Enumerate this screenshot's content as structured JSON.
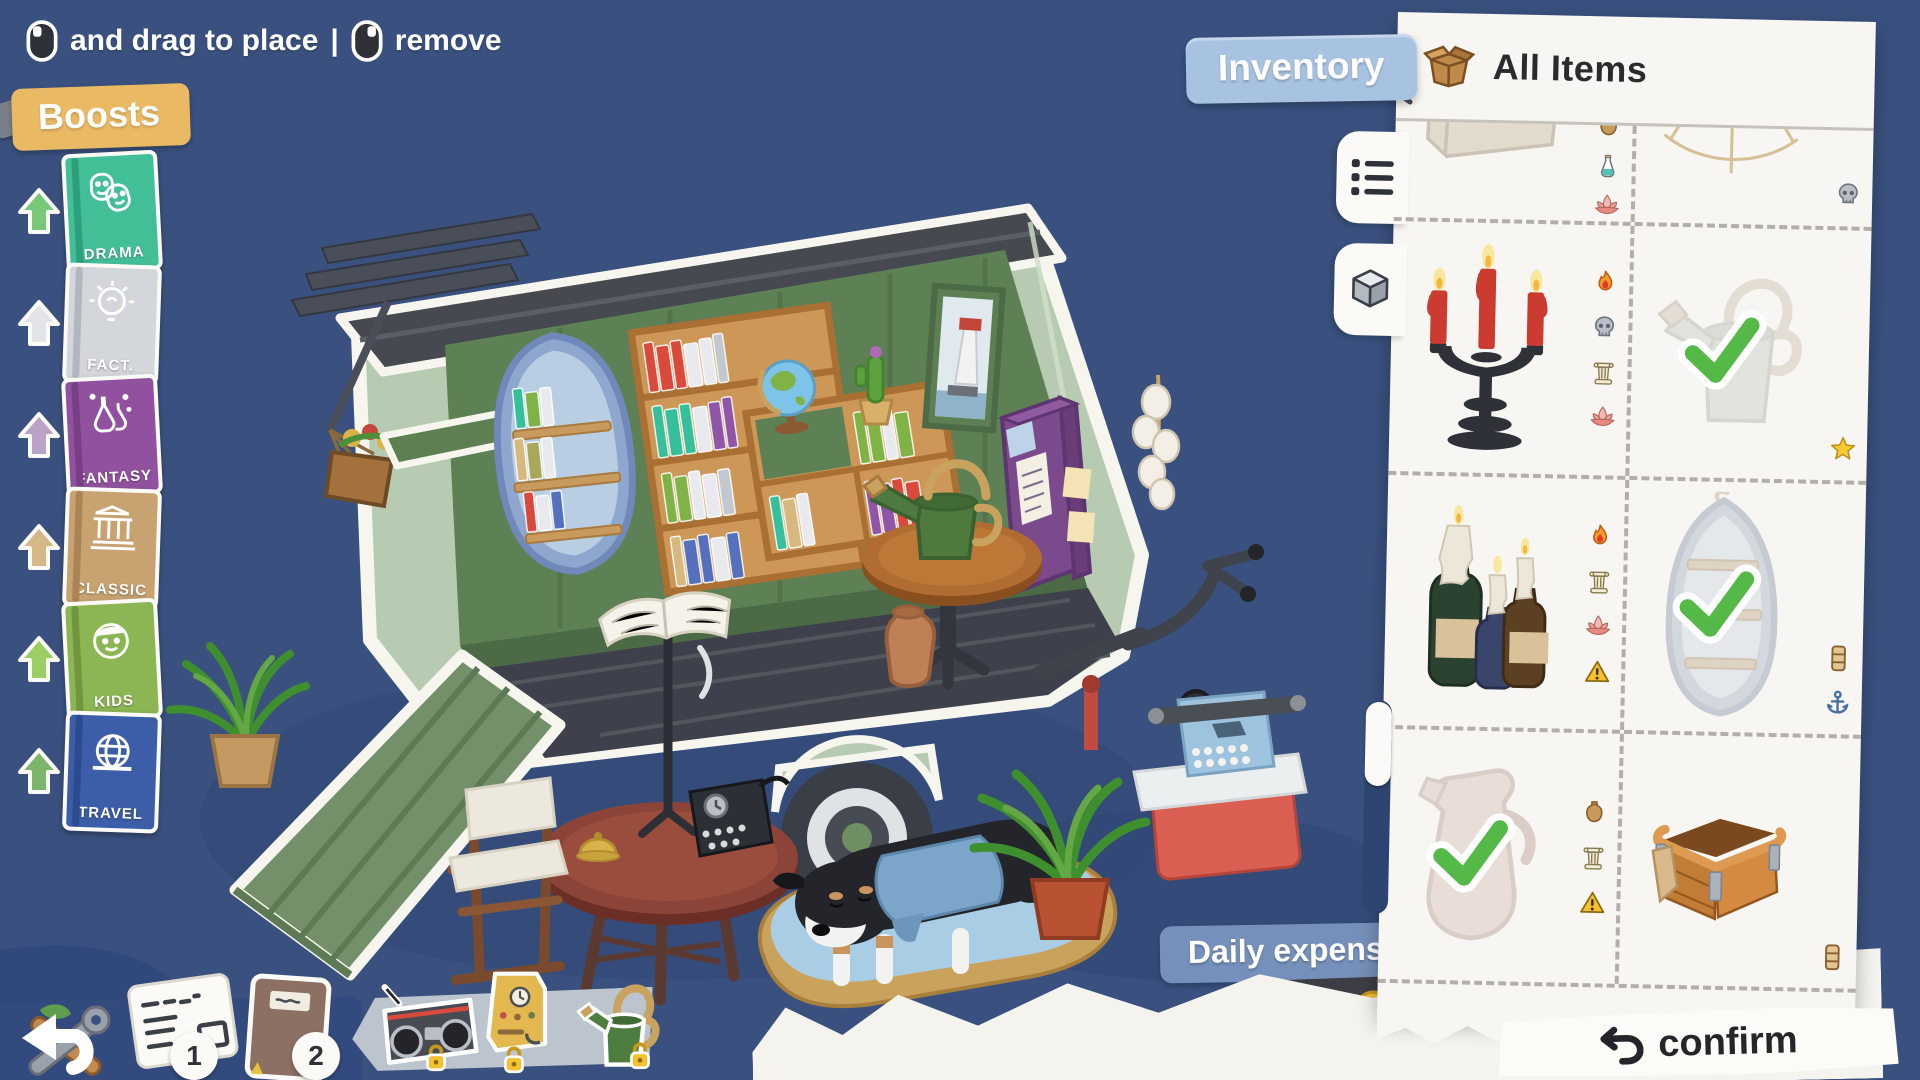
{
  "colors": {
    "background": "#3a517f",
    "panel": "#f8f6f2",
    "boosts_tag": "#e9b963",
    "inventory_button": "#a8c2e2",
    "expenses_label": "#7590ba",
    "expenses_chip": "#3d3d45",
    "check_green": "#55b948",
    "coin_gold": "#f2c230",
    "dashed_divider": "#b3afa8"
  },
  "hints": {
    "drag_label": "and drag to place",
    "divider": "|",
    "remove_label": "remove"
  },
  "boosts": {
    "label": "Boosts",
    "books": [
      {
        "label": "DRAMA",
        "icon": "theater-masks-icon",
        "cover": "#43bf97",
        "spine": "#2d9f7c",
        "arrow": "#79c878"
      },
      {
        "label": "FACT.",
        "icon": "lightbulb-icon",
        "cover": "#d3d6da",
        "spine": "#b2b6be",
        "arrow": "#e2e5e8"
      },
      {
        "label": "FANTASY",
        "icon": "potion-flasks-icon",
        "cover": "#91519f",
        "spine": "#773f85",
        "arrow": "#b9a3c6"
      },
      {
        "label": "CLASSIC",
        "icon": "greek-temple-icon",
        "cover": "#c8a271",
        "spine": "#aa8455",
        "arrow": "#d6b887"
      },
      {
        "label": "KIDS",
        "icon": "child-face-icon",
        "cover": "#8cb553",
        "spine": "#71963e",
        "arrow": "#9ccf63"
      },
      {
        "label": "TRAVEL",
        "icon": "globe-icon",
        "cover": "#3c5da8",
        "spine": "#2c4a8e",
        "arrow": "#7db56a"
      }
    ]
  },
  "inventory": {
    "button_label": "Inventory",
    "title": "All Items",
    "title_icon": "open-box-icon",
    "view_tabs": [
      {
        "name": "list-view",
        "icon": "list-icon",
        "active": true
      },
      {
        "name": "cube-view",
        "icon": "cube-icon",
        "active": false
      }
    ],
    "items": [
      {
        "name": "storage-box",
        "placed": true,
        "checked": false,
        "badges": [
          "vase",
          "potion",
          "lotus"
        ],
        "badge_align": "top"
      },
      {
        "name": "spider-web",
        "placed": false,
        "checked": false,
        "badges": [
          "skull"
        ],
        "badge_align": "bottom"
      },
      {
        "name": "candelabra",
        "placed": false,
        "checked": false,
        "badges": [
          "fire",
          "skull",
          "column",
          "lotus"
        ],
        "badge_align": "center"
      },
      {
        "name": "watering-can",
        "placed": true,
        "checked": true,
        "badges": [
          "star"
        ],
        "badge_align": "bottom"
      },
      {
        "name": "bottle-candles",
        "placed": false,
        "checked": false,
        "badges": [
          "fire",
          "column",
          "lotus",
          "warning"
        ],
        "badge_align": "center"
      },
      {
        "name": "boat-shelf",
        "placed": true,
        "checked": true,
        "badges": [
          "shelf",
          "anchor"
        ],
        "badge_align": "bottom"
      },
      {
        "name": "jug",
        "placed": true,
        "checked": true,
        "badges": [
          "vase",
          "column",
          "warning"
        ],
        "badge_align": "center"
      },
      {
        "name": "wooden-crate",
        "placed": false,
        "checked": false,
        "badges": [
          "shelf"
        ],
        "badge_align": "bottom"
      }
    ]
  },
  "expenses": {
    "label": "Daily expenses",
    "amount": "+40",
    "coin_icon": "coin-icon"
  },
  "confirm": {
    "label": "confirm",
    "icon": "undo-arrow-icon"
  },
  "dock": {
    "mail_badge": "1",
    "journal_badge": "2"
  },
  "tray": {
    "locked": true,
    "items": [
      "boombox",
      "coffee-machine",
      "watering-can-green"
    ],
    "lock_icon": "lock-icon"
  }
}
